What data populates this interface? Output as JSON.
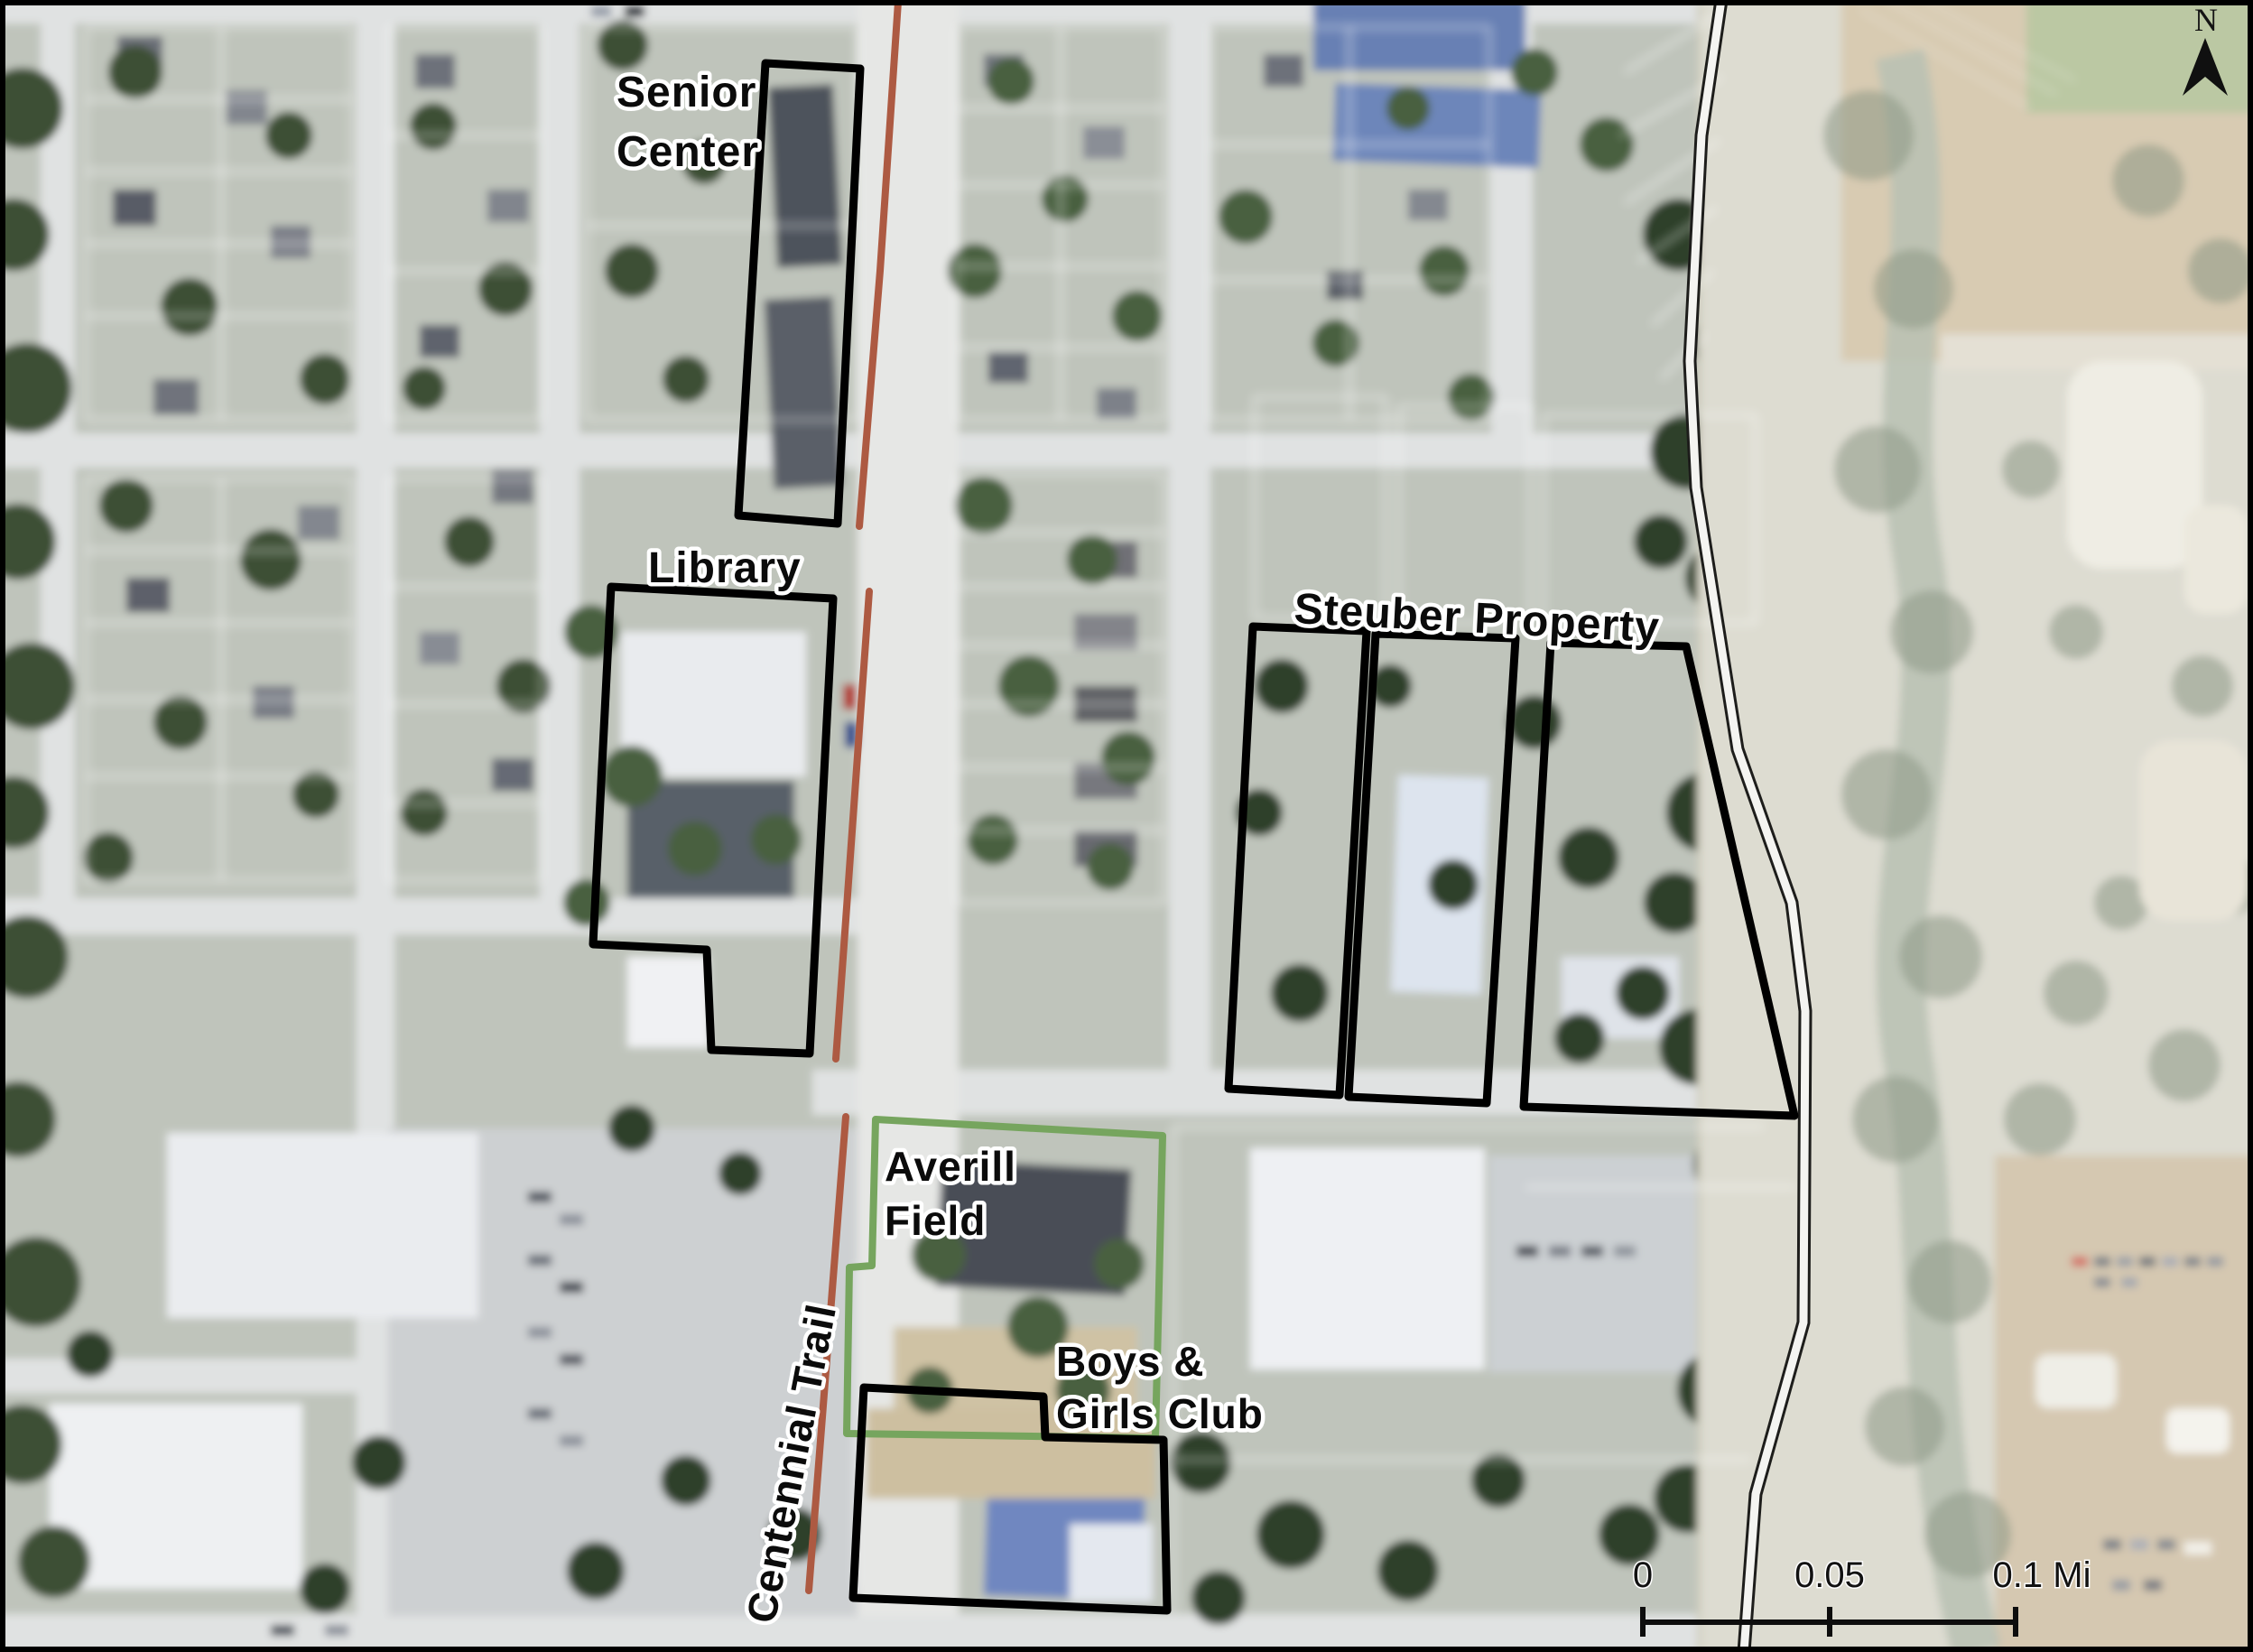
{
  "map": {
    "labels": {
      "senior_center_line1": "Senior",
      "senior_center_line2": "Center",
      "library": "Library",
      "steuber": "Steuber Property",
      "averill_line1": "Averill",
      "averill_line2": "Field",
      "boys_line1": "Boys &",
      "boys_line2": "Girls Club",
      "trail": "Centennial Trail"
    },
    "scale": {
      "ticks": [
        "0",
        "0.05",
        "0.1 Mi"
      ]
    },
    "north_label": "N",
    "colors": {
      "site_outline": "#000000",
      "field_outline_green": "#76a55e",
      "trail_brown": "#ad5a42",
      "parcel_line_white": "#ffffff",
      "boundary_casing": "#1d1d1b",
      "boundary_fill": "#f4f4f1",
      "frame": "#000000"
    }
  }
}
